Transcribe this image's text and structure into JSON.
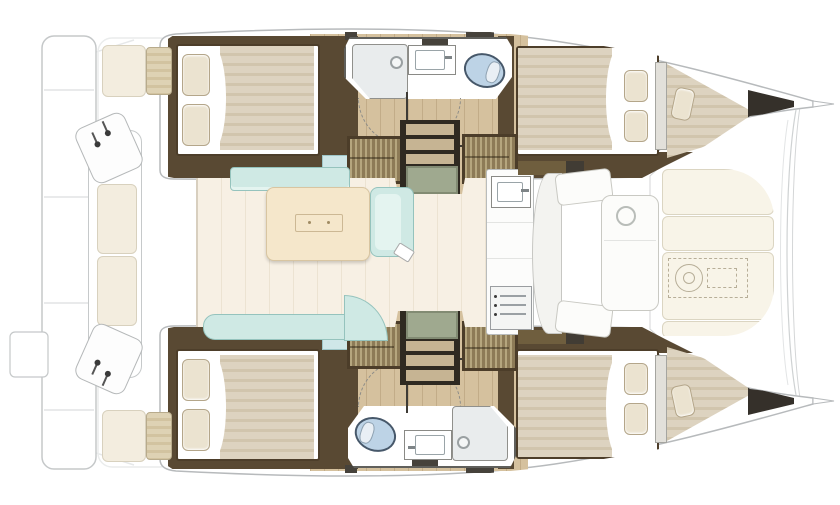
{
  "colors": {
    "wood": "#d5c19e",
    "wall": "#594933",
    "wallDark": "#46423b",
    "bedFrame": "#4d3e2a",
    "duvet": "#ddd3c0",
    "duvetStripe": "#d1c5ad",
    "pillow": "#ebe3d0",
    "pillowEdge": "#b4a68a",
    "blueSeat": "#cfe7e8",
    "bath": "#ffffff",
    "bathEdge": "#60605c",
    "shower": "#e9eced",
    "steel": "#7e8487",
    "toilet": "#bdd3e6",
    "toiletEdge": "#47586a",
    "locker": "#8d7b57",
    "lockerStripe": "#b5a67e",
    "lockerFrame": "#4c3d29",
    "stepTan": "#c6b493",
    "stepDark": "#2f2a21",
    "mat": "#9fa98f",
    "dashed": "#8c8c88",
    "arrow": "#3e3b35",
    "floor": "#f7f0e4",
    "floorLine": "#ece3d2",
    "mint": "#cfe9e4",
    "mintEdge": "#95c3bd",
    "mintLight": "#e4f4f0",
    "table": "#f5e7cb",
    "tableEdge": "#d8c5a1",
    "counter": "#fcfcfb",
    "counterEdge": "#b9bcbc",
    "connector": "#6f5e3e",
    "connectorDark": "#413c34",
    "pad": "#f8f4e8",
    "padEdge": "#dbd5c2",
    "cream": "#f3eddf",
    "creamEdge": "#d8d1be",
    "windlass": "#b7ae98",
    "outline": "#b7babc",
    "ghost": "#e6e8e9",
    "darkTip": "#35302a"
  },
  "icons": {
    "toilet": "toilet-icon",
    "washbasin": "sink-icon",
    "shower": "shower-icon",
    "double_berth": "bed-icon",
    "wardrobe": "wardrobe-icon",
    "stairs": "stairs-icon",
    "dining_table": "table-icon",
    "sofa": "sofa-icon",
    "stove": "stove-icon",
    "galley_sink": "sink-icon",
    "windlass": "winch-icon",
    "helm_levers": "throttle-icon",
    "sun_pad": "cushion-icon"
  }
}
